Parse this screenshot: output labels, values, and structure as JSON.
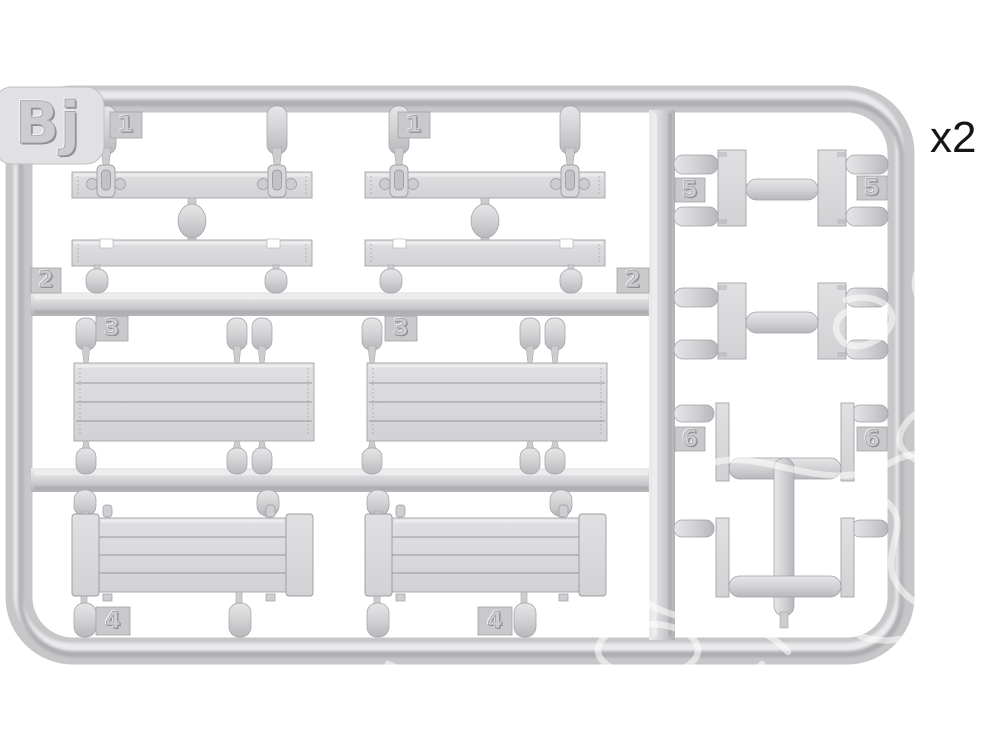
{
  "photo": {
    "subject": "Injection-molded light grey plastic model kit sprue (runner) photographed on a white background, with numbered part tags and a faint white watermark over the right side",
    "background_color": "#ffffff",
    "plastic_base_color": "#cfcfd2",
    "plastic_highlight_color": "#eaeaec",
    "plastic_shadow_color": "#a7a7ab",
    "label_text_color": "#161616",
    "watermark_color": "#ffffff"
  },
  "labels": {
    "sprue_code": "Bj",
    "quantity": "x2",
    "part_numbers": {
      "p1": "1",
      "p2": "2",
      "p3": "3",
      "p4": "4",
      "p5": "5",
      "p6": "6"
    }
  }
}
